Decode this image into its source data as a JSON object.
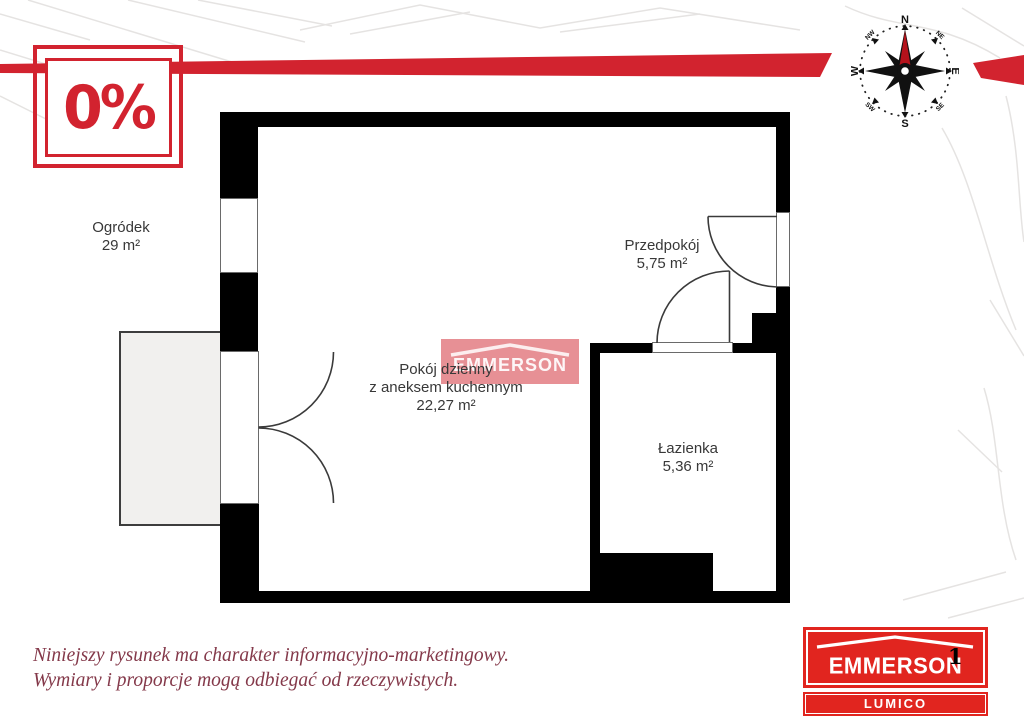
{
  "badge": {
    "label": "0%"
  },
  "compass": {
    "n": "N",
    "e": "E",
    "s": "S",
    "w": "W",
    "ne": "NE",
    "nw": "NW",
    "se": "SE",
    "sw": "SW"
  },
  "rooms": {
    "garden": {
      "name": "Ogródek",
      "area": "29 m²"
    },
    "living": {
      "name_line1": "Pokój dzienny",
      "name_line2": "z aneksem kuchennym",
      "area": "22,27 m²"
    },
    "hallway": {
      "name": "Przedpokój",
      "area": "5,75 m²"
    },
    "bathroom": {
      "name": "Łazienka",
      "area": "5,36 m²"
    }
  },
  "watermark": {
    "text": "EMMERSON"
  },
  "disclaimer": {
    "line1": "Niniejszy rysunek ma charakter informacyjno-marketingowy.",
    "line2": "Wymiary i proporcje mogą odbiegać od rzeczywistych."
  },
  "logo": {
    "brand": "EMMERSON",
    "sub": "LUMICO"
  },
  "page_number": "1",
  "colors": {
    "accent_red": "#d2232f",
    "logo_red": "#e1251f",
    "compass_needle_red": "#b5121b",
    "disclaimer_maroon": "#84394a",
    "wall_black": "#000000",
    "terrace_gray": "#f1f0ee"
  }
}
